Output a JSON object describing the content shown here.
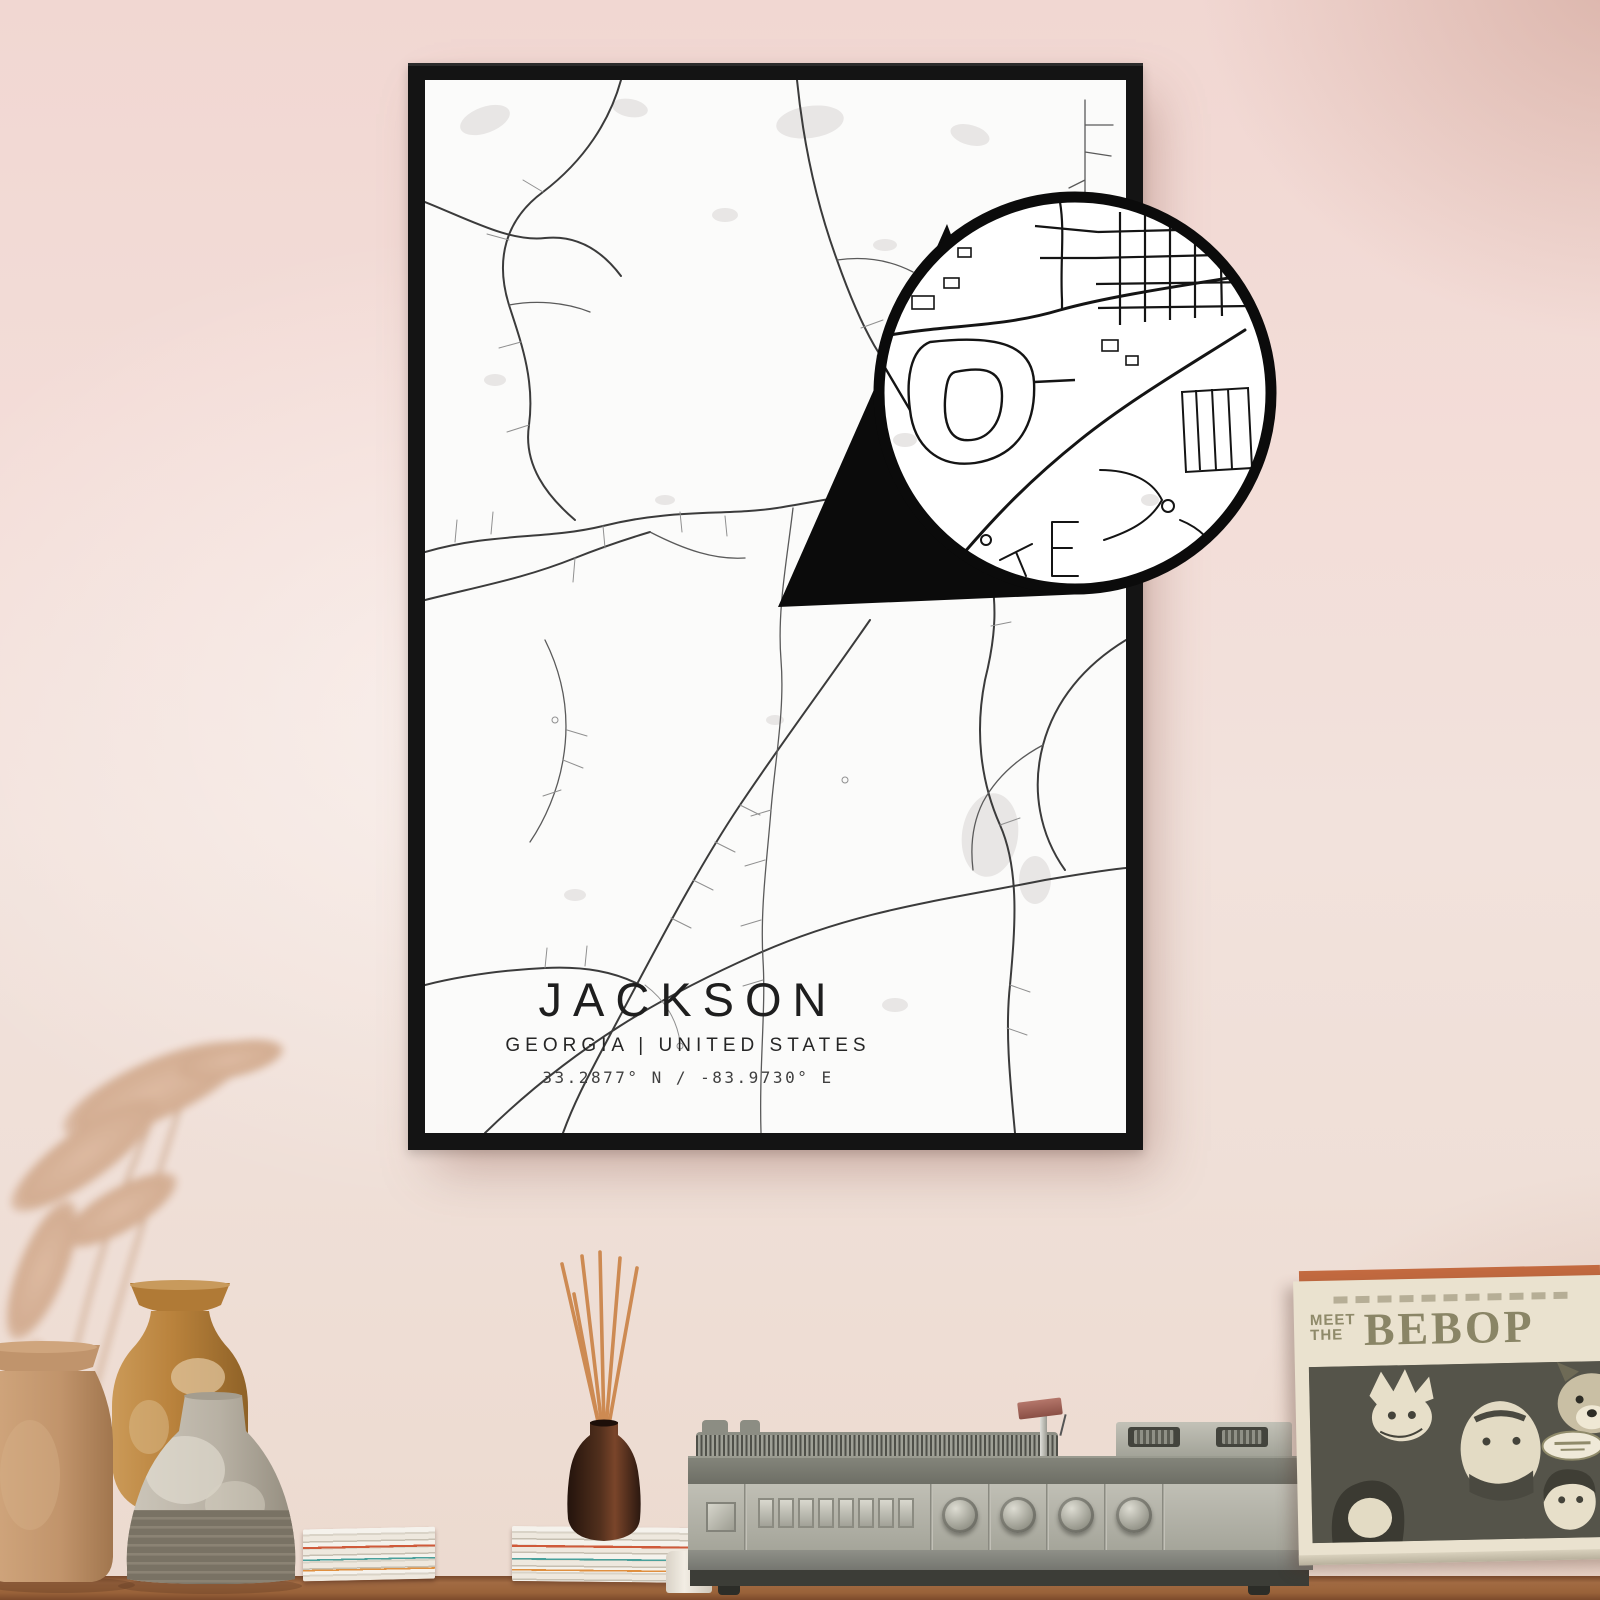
{
  "scene": {
    "description": "Framed city map poster mockup on a pink wall above a shelf with vases, reed diffuser, vintage turntable and a record sleeve",
    "wall_color": "#f1d9d3",
    "table_color": "#996239",
    "frame_color": "#141414",
    "poster_background": "#fbfbfa",
    "map_road_color": "#3b3b3b",
    "map_water_patch_color": "#e8e6e5"
  },
  "poster": {
    "title": "JACKSON",
    "subtitle": "GEORGIA | UNITED STATES",
    "coordinates": "33.2877° N / -83.9730° E"
  },
  "callout": {
    "shape": "magnifier-circle-with-tail",
    "ring_color": "#0b0b0b"
  },
  "sleeve": {
    "meet_label": "MEET",
    "the_label": "THE",
    "title": "BEBOP",
    "background": "#eae2cf",
    "text_color": "#8a8566"
  },
  "shelf": {
    "reed_color": "#cd8a52",
    "bottle_color": "#3a2417",
    "vase_tan_color": "#c79e78",
    "vase_amber_color": "#c08a45",
    "vase_gray_color": "#bdb7ab"
  }
}
